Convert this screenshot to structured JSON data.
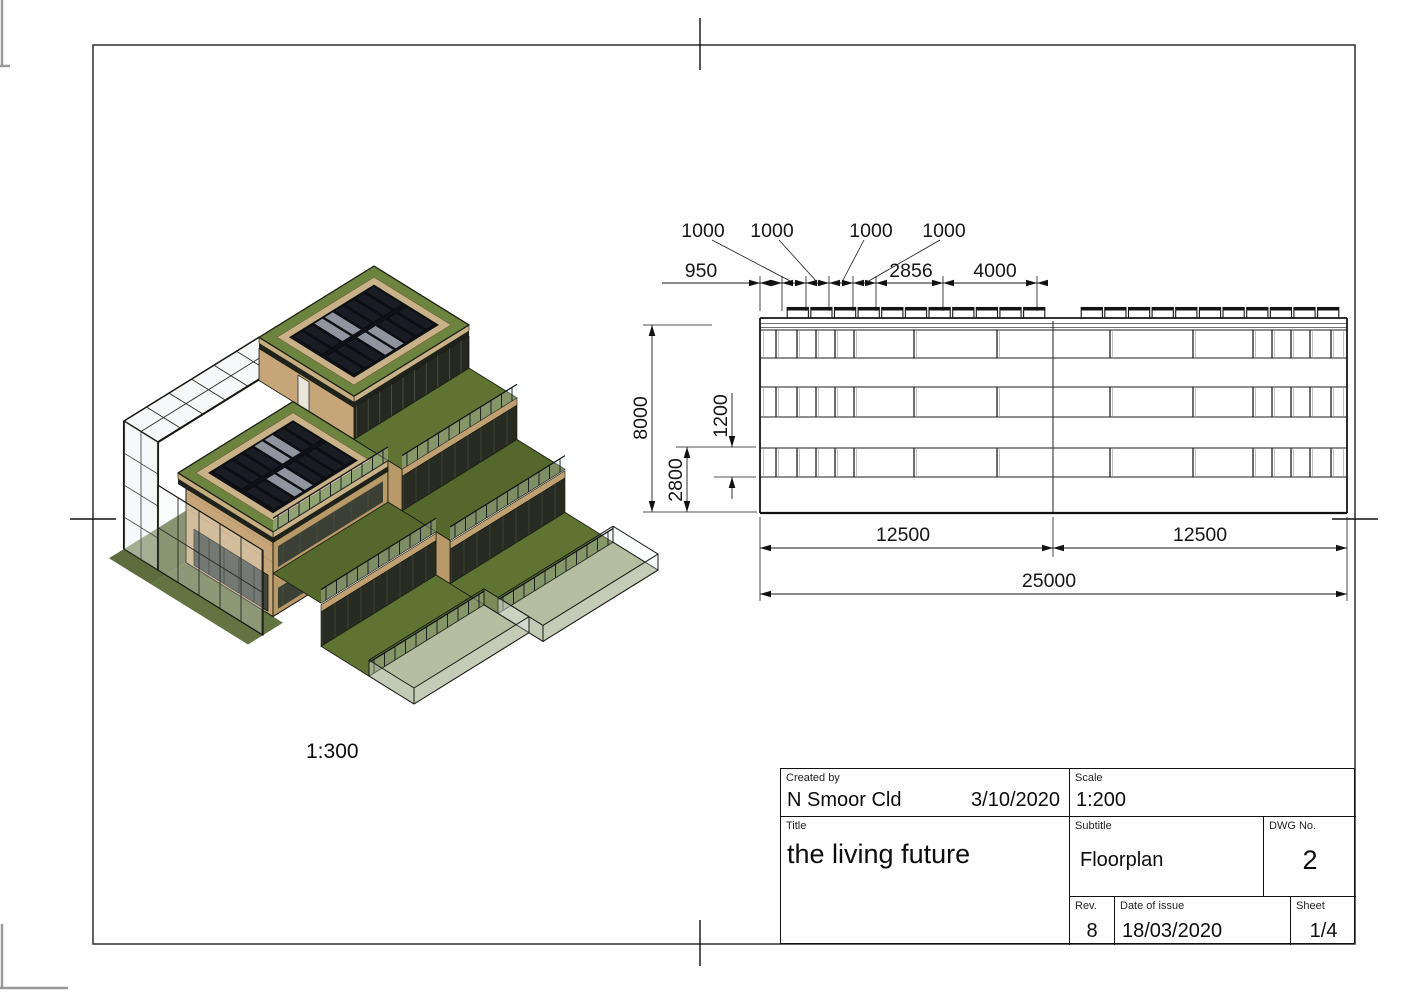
{
  "render": {
    "scale_label": "1:300",
    "colors": {
      "grass": "#5f7433",
      "solar_panel": "#191c22",
      "wood": "#c6a678",
      "glass": "#edf2f3"
    }
  },
  "elevation": {
    "dims_top": {
      "d950": "950",
      "d1000_labels": [
        "1000",
        "1000",
        "1000",
        "1000"
      ],
      "d2856": "2856",
      "d4000": "4000"
    },
    "dims_left": {
      "d8000": "8000",
      "d1200": "1200",
      "d2800": "2800"
    },
    "dims_bottom": {
      "d12500_left": "12500",
      "d12500_right": "12500",
      "d25000": "25000"
    }
  },
  "titleblock": {
    "created_by_label": "Created by",
    "created_by": "N Smoor Cld",
    "created_date": "3/10/2020",
    "scale_label": "Scale",
    "scale": "1:200",
    "title_label": "Title",
    "title": "the living future",
    "subtitle_label": "Subtitle",
    "subtitle": "Floorplan",
    "dwg_label": "DWG No.",
    "dwg_no": "2",
    "rev_label": "Rev.",
    "rev": "8",
    "date_of_issue_label": "Date of issue",
    "date_of_issue": "18/03/2020",
    "sheet_label": "Sheet",
    "sheet": "1/4"
  }
}
